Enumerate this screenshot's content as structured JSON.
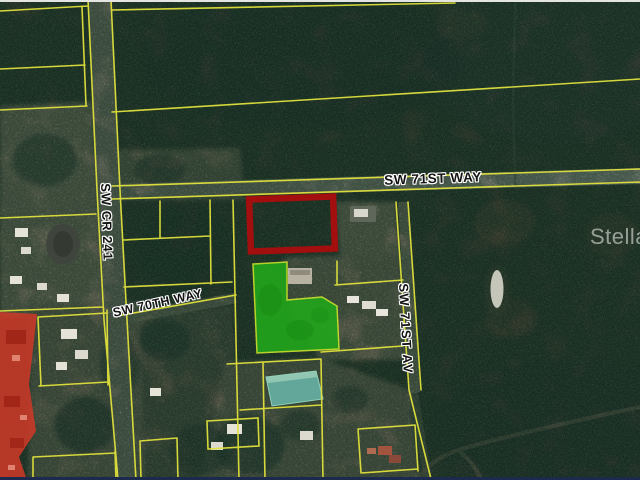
{
  "map": {
    "road_labels": {
      "main_ew_road": "SW 71ST WAY",
      "county_road": "SW CR 241",
      "secondary_ew_road": "SW 70TH WAY",
      "ns_avenue": "SW 71ST AV"
    },
    "watermark_text": "Stellar",
    "colors": {
      "subject_parcel_outline_red": "#a30e0e",
      "highlight_parcel_green": "#22a31c",
      "highlight_parcel_green_border": "#c6df2c",
      "parcel_boundary_yellow": "#dfe03c",
      "zoning_overlay_red": "#ce3a28",
      "pond_teal": "#63a79a"
    }
  }
}
